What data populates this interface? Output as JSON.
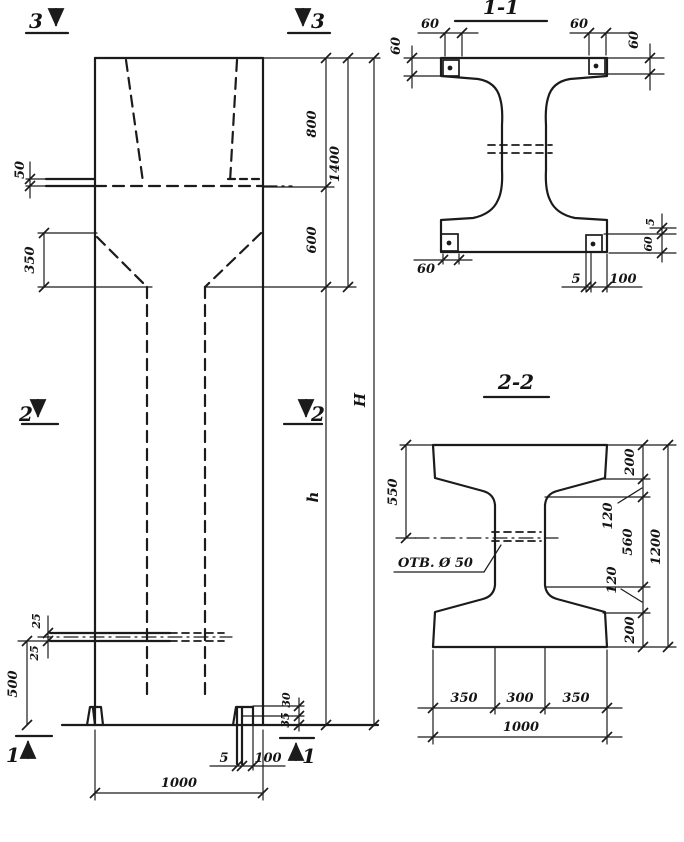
{
  "page": {
    "background": "#ffffff",
    "ink": "#1b1b1b"
  },
  "elevation": {
    "markers": {
      "top_left": "3",
      "top_right": "3",
      "mid_left": "2",
      "mid_right": "2",
      "bottom_left": "1",
      "bottom_right": "1"
    },
    "dims": {
      "console_depth": "50",
      "taper_height": "350",
      "head_upper": "800",
      "head_lower": "600",
      "head_total": "1400",
      "shaft_height": "h",
      "total_height": "H",
      "slot_upper": "25",
      "slot_lower": "25",
      "base_height": "500",
      "foot_lip_upper": "30",
      "foot_lip_lower": "35",
      "foot_plate_thickness": "5",
      "foot_width": "100",
      "width": "1000"
    }
  },
  "section_1_1": {
    "title": "1-1",
    "dims": {
      "plate_offset_top_left": "60",
      "plate_offset_top_right": "60",
      "flange_depth_left": "60",
      "flange_depth_right": "60",
      "plate_offset_bottom": "60",
      "plate_thickness_bottom": "5",
      "plate_width_bottom": "100",
      "plate_gap_right": "5",
      "plate_depth_right": "60"
    }
  },
  "section_2_2": {
    "title": "2-2",
    "hole_label": "ОТВ. Ø 50",
    "dims": {
      "top_to_hole": "550",
      "flange_top": "200",
      "haunch_top": "120",
      "web_height": "560",
      "haunch_bottom": "120",
      "flange_bottom": "200",
      "total_height": "1200",
      "bottom_left": "350",
      "bottom_middle": "300",
      "bottom_right": "350",
      "bottom_total": "1000"
    }
  }
}
